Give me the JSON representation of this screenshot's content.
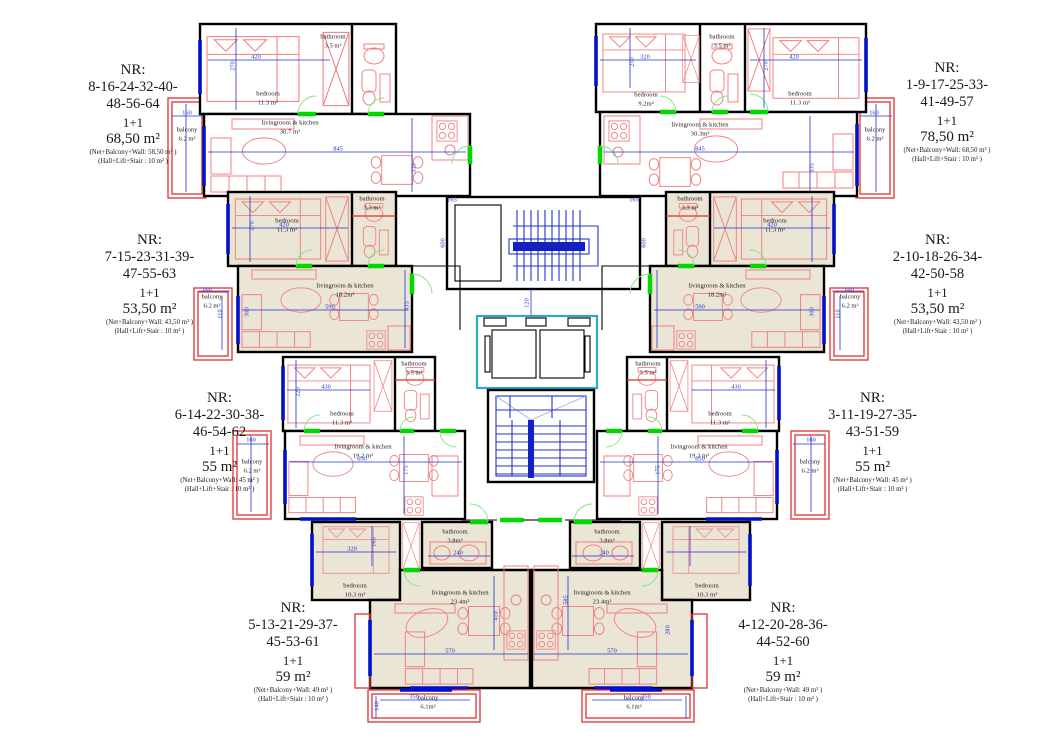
{
  "apartments": [
    {
      "nr": "NR:",
      "numbers1": "8-16-24-32-40-",
      "numbers2": "48-56-64",
      "type": "1+1",
      "area": "68,50 m²",
      "net": "(Net+Balcony+Wall: 58,50 m² )",
      "hall": "(Hall+Lift+Stair : 10 m² )"
    },
    {
      "nr": "NR:",
      "numbers1": "1-9-17-25-33-",
      "numbers2": "41-49-57",
      "type": "1+1",
      "area": "78,50 m²",
      "net": "(Net+Balcony+Wall: 68,50 m² )",
      "hall": "(Hall+Lift+Stair : 10 m² )"
    },
    {
      "nr": "NR:",
      "numbers1": "7-15-23-31-39-",
      "numbers2": "47-55-63",
      "type": "1+1",
      "area": "53,50 m²",
      "net": "(Net+Balcony+Wall: 43,50 m² )",
      "hall": "(Hall+Lift+Stair : 10 m² )"
    },
    {
      "nr": "NR:",
      "numbers1": "2-10-18-26-34-",
      "numbers2": "42-50-58",
      "type": "1+1",
      "area": "53,50 m²",
      "net": "(Net+Balcony+Wall: 43,50 m² )",
      "hall": "(Hall+Lift+Stair : 10 m² )"
    },
    {
      "nr": "NR:",
      "numbers1": "6-14-22-30-38-",
      "numbers2": "46-54-62",
      "type": "1+1",
      "area": "55  m²",
      "net": "(Net+Balcony+Wall: 45 m² )",
      "hall": "(Hall+Lift+Stair : 10 m² )"
    },
    {
      "nr": "NR:",
      "numbers1": "3-11-19-27-35-",
      "numbers2": "43-51-59",
      "type": "1+1",
      "area": "55  m²",
      "net": "(Net+Balcony+Wall: 45 m² )",
      "hall": "(Hall+Lift+Stair : 10 m² )"
    },
    {
      "nr": "NR:",
      "numbers1": "5-13-21-29-37-",
      "numbers2": "45-53-61",
      "type": "1+1",
      "area": "59  m²",
      "net": "(Net+Balcony+Wall: 49 m² )",
      "hall": "(Hall+Lift+Stair : 10 m² )"
    },
    {
      "nr": "NR:",
      "numbers1": "4-12-20-28-36-",
      "numbers2": "44-52-60",
      "type": "1+1",
      "area": "59  m²",
      "net": "(Net+Balcony+Wall: 49 m² )",
      "hall": "(Hall+Lift+Stair : 10 m² )"
    }
  ],
  "room_labels": [
    {
      "text": "bedroom\n11.3 m²",
      "x": 268,
      "y": 99
    },
    {
      "text": "bathroom\n3.5 m²",
      "x": 333,
      "y": 42
    },
    {
      "text": "livingroom & kitchen\n30.7 m²",
      "x": 290,
      "y": 128
    },
    {
      "text": "balcony\n6.2 m²",
      "x": 187,
      "y": 135
    },
    {
      "text": "bedroom\n9.2m²",
      "x": 646,
      "y": 100
    },
    {
      "text": "bathroom\n3.5 m²",
      "x": 722,
      "y": 42
    },
    {
      "text": "bedroom\n11.3 m²",
      "x": 800,
      "y": 99
    },
    {
      "text": "livingroom & kitchen\n30.3m²",
      "x": 700,
      "y": 130
    },
    {
      "text": "balcony\n6.2 m²",
      "x": 875,
      "y": 135
    },
    {
      "text": "bedroom\n11.3 m²",
      "x": 287,
      "y": 226
    },
    {
      "text": "bathroom\n3.3 m²",
      "x": 372,
      "y": 204
    },
    {
      "text": "livingroom & kitchen\n18.2m²",
      "x": 345,
      "y": 291
    },
    {
      "text": "balcony\n6.2 m²",
      "x": 212,
      "y": 302
    },
    {
      "text": "bathroom\n3.3 m²",
      "x": 690,
      "y": 204
    },
    {
      "text": "bedroom\n11.3 m²",
      "x": 775,
      "y": 226
    },
    {
      "text": "livingroom & kitchen\n18.2m²",
      "x": 717,
      "y": 291
    },
    {
      "text": "balcony\n6.2 m²",
      "x": 850,
      "y": 302
    },
    {
      "text": "bedroom\n11.3 m²",
      "x": 342,
      "y": 419
    },
    {
      "text": "bathroom\n3.5 m²",
      "x": 414,
      "y": 369
    },
    {
      "text": "livingroom & kitchen\n19.2 m²",
      "x": 363,
      "y": 452
    },
    {
      "text": "balcony\n6.2 m²",
      "x": 252,
      "y": 467
    },
    {
      "text": "bathroom\n3.5 m²",
      "x": 648,
      "y": 369
    },
    {
      "text": "bedroom\n11.3 m²",
      "x": 720,
      "y": 419
    },
    {
      "text": "livingroom & kitchen\n19.2 m²",
      "x": 699,
      "y": 452
    },
    {
      "text": "balcony\n6.2 m²",
      "x": 810,
      "y": 467
    },
    {
      "text": "bedroom\n10.3 m²",
      "x": 355,
      "y": 591
    },
    {
      "text": "bathroom\n3.8m²",
      "x": 455,
      "y": 537
    },
    {
      "text": "livingroom & kitchen\n23.4m²",
      "x": 460,
      "y": 598
    },
    {
      "text": "balcony\n6.1m²",
      "x": 428,
      "y": 703
    },
    {
      "text": "bathroom\n3.8m²",
      "x": 607,
      "y": 537
    },
    {
      "text": "bedroom\n10.3 m²",
      "x": 707,
      "y": 591
    },
    {
      "text": "livingroom & kitchen\n23.4m²",
      "x": 602,
      "y": 598
    },
    {
      "text": "balcony\n6.1m²",
      "x": 634,
      "y": 703
    }
  ],
  "dim_labels": [
    {
      "text": "420",
      "x": 256,
      "y": 57
    },
    {
      "text": "270",
      "x": 233,
      "y": 66,
      "vert": 1
    },
    {
      "text": "845",
      "x": 338,
      "y": 149
    },
    {
      "text": "335",
      "x": 414,
      "y": 168,
      "vert": 1
    },
    {
      "text": "160",
      "x": 187,
      "y": 113
    },
    {
      "text": "165",
      "x": 452,
      "y": 200
    },
    {
      "text": "420",
      "x": 794,
      "y": 57
    },
    {
      "text": "270",
      "x": 766,
      "y": 66,
      "vert": 1
    },
    {
      "text": "320",
      "x": 645,
      "y": 57
    },
    {
      "text": "250",
      "x": 632,
      "y": 62,
      "vert": 1
    },
    {
      "text": "845",
      "x": 700,
      "y": 149
    },
    {
      "text": "335",
      "x": 812,
      "y": 168,
      "vert": 1
    },
    {
      "text": "160",
      "x": 874,
      "y": 113
    },
    {
      "text": "165",
      "x": 634,
      "y": 200
    },
    {
      "text": "600",
      "x": 443,
      "y": 243,
      "vert": 1
    },
    {
      "text": "600",
      "x": 644,
      "y": 243,
      "vert": 1
    },
    {
      "text": "120",
      "x": 527,
      "y": 303,
      "vert": 1
    },
    {
      "text": "420",
      "x": 284,
      "y": 225
    },
    {
      "text": "270",
      "x": 252,
      "y": 226,
      "vert": 1
    },
    {
      "text": "590",
      "x": 330,
      "y": 307
    },
    {
      "text": "300",
      "x": 247,
      "y": 312,
      "vert": 1
    },
    {
      "text": "335",
      "x": 407,
      "y": 306,
      "vert": 1
    },
    {
      "text": "160",
      "x": 207,
      "y": 290
    },
    {
      "text": "110",
      "x": 220,
      "y": 314,
      "vert": 1
    },
    {
      "text": "420",
      "x": 772,
      "y": 225
    },
    {
      "text": "590",
      "x": 700,
      "y": 307
    },
    {
      "text": "300",
      "x": 812,
      "y": 312,
      "vert": 1
    },
    {
      "text": "160",
      "x": 849,
      "y": 290
    },
    {
      "text": "110",
      "x": 838,
      "y": 314,
      "vert": 1
    },
    {
      "text": "430",
      "x": 326,
      "y": 387
    },
    {
      "text": "220",
      "x": 298,
      "y": 392,
      "vert": 1
    },
    {
      "text": "650",
      "x": 362,
      "y": 459
    },
    {
      "text": "175",
      "x": 406,
      "y": 470,
      "vert": 1
    },
    {
      "text": "160",
      "x": 251,
      "y": 440
    },
    {
      "text": "430",
      "x": 736,
      "y": 387
    },
    {
      "text": "650",
      "x": 700,
      "y": 459
    },
    {
      "text": "175",
      "x": 658,
      "y": 470,
      "vert": 1
    },
    {
      "text": "160",
      "x": 811,
      "y": 440
    },
    {
      "text": "320",
      "x": 352,
      "y": 549
    },
    {
      "text": "165",
      "x": 374,
      "y": 542,
      "vert": 1
    },
    {
      "text": "240",
      "x": 458,
      "y": 553
    },
    {
      "text": "570",
      "x": 450,
      "y": 651
    },
    {
      "text": "410",
      "x": 496,
      "y": 616,
      "vert": 1
    },
    {
      "text": "240",
      "x": 604,
      "y": 553
    },
    {
      "text": "570",
      "x": 612,
      "y": 651
    },
    {
      "text": "585",
      "x": 566,
      "y": 600,
      "vert": 1
    },
    {
      "text": "280",
      "x": 668,
      "y": 630,
      "vert": 1
    },
    {
      "text": "350",
      "x": 414,
      "y": 697
    },
    {
      "text": "140",
      "x": 377,
      "y": 706,
      "vert": 1
    },
    {
      "text": "350",
      "x": 646,
      "y": 697
    }
  ],
  "colors": {
    "wall": "#000000",
    "furniture_red": "#f08080",
    "balcony_red": "#e23131",
    "dimension_blue": "#2233c8",
    "window_blue": "#0011cc",
    "door_green": "#00d800",
    "elevator_cyan": "#2fa8cf",
    "fill_beige": "#eae5d5",
    "fill_gray": "#e9e9e9"
  }
}
